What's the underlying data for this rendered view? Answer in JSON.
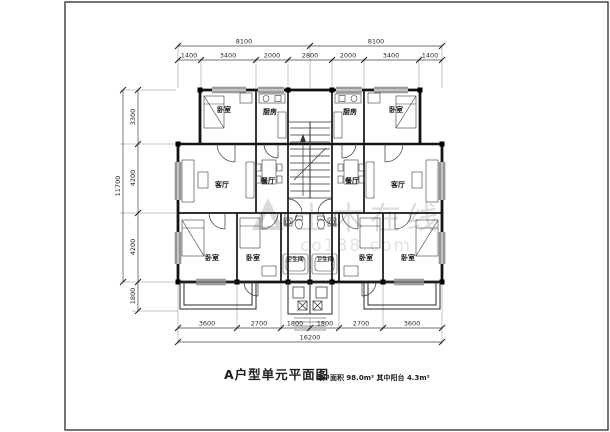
{
  "title": {
    "main": "A户型单元平面图",
    "note": "每户面积 98.0m²  其中阳台 4.3m²"
  },
  "watermark": {
    "name": "土木在线",
    "sub": "co188.com"
  },
  "dims": {
    "top_overall": [
      "8100",
      "8100"
    ],
    "top_segments": [
      "1400",
      "3400",
      "2000",
      "2800",
      "2000",
      "3400",
      "1400"
    ],
    "left_overall": "11700",
    "left_segments": [
      "3300",
      "4200",
      "4200",
      "1800"
    ],
    "bottom_segments": [
      "3600",
      "2700",
      "1800",
      "1800",
      "2700",
      "3600"
    ],
    "bottom_overall": "16200"
  },
  "rooms": {
    "bedroom_tl": "卧室",
    "kitchen_l": "厨房",
    "kitchen_r": "厨房",
    "bedroom_tr": "卧室",
    "living_l": "客厅",
    "dining_l": "餐厅",
    "dining_r": "餐厅",
    "living_r": "客厅",
    "bedroom_bl1": "卧室",
    "bedroom_bl2": "卧室",
    "bath_l": "卫生间",
    "bath_r": "卫生间",
    "bedroom_br1": "卧室",
    "bedroom_br2": "卧室"
  }
}
